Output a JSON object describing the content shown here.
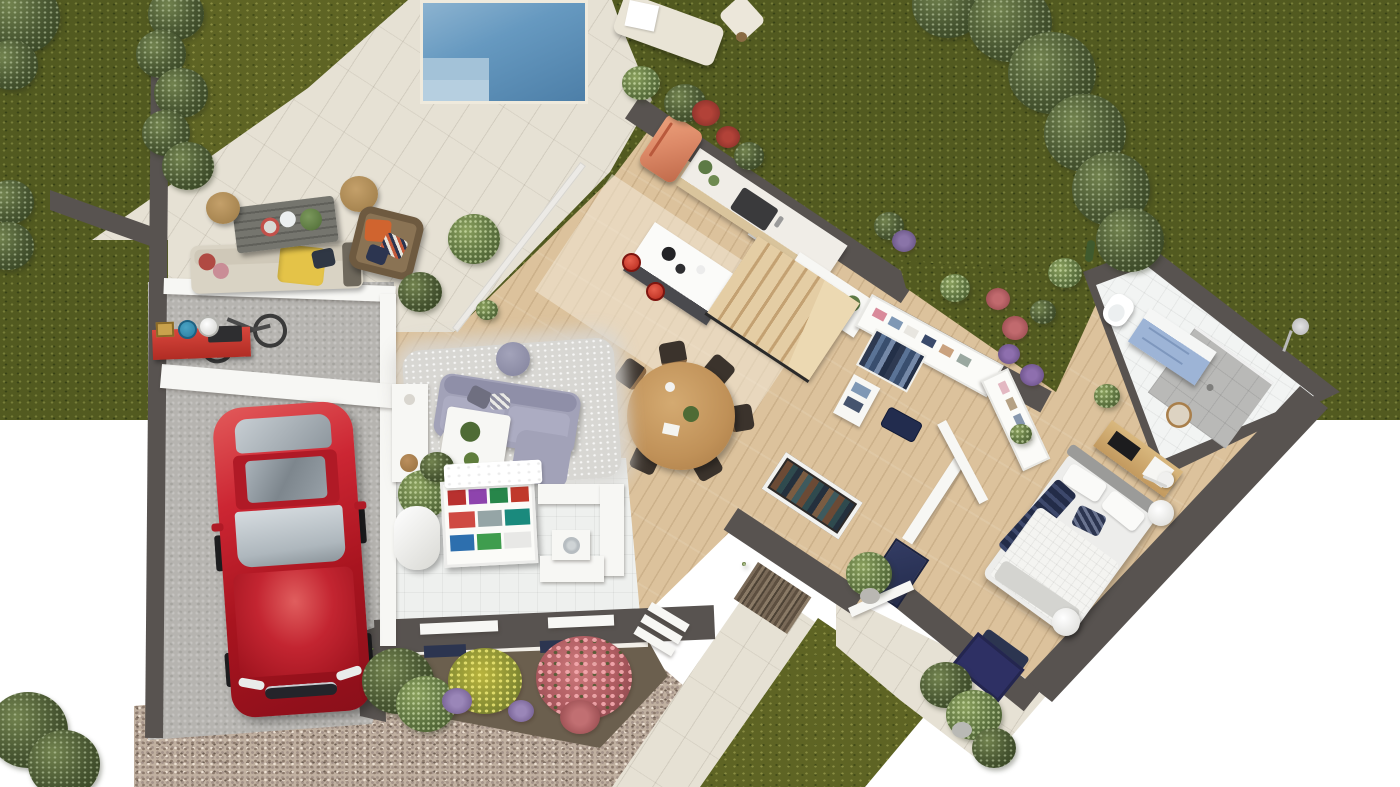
{
  "scene": {
    "type": "3d-floor-plan-render",
    "description": "Top-down 3D architectural rendering of a single-storey house ground floor with garden, swimming pool, terraces, garage with red car, and gravel driveway on a white background",
    "background_color": "#ffffff",
    "visible_text": "none"
  },
  "palette": {
    "exterior_wall": "#585350",
    "interior_wall": "#f7f7f4",
    "wood_floor": "#dcc29c",
    "pavers": "#e6e1d4",
    "concrete": "#b6b4b0",
    "gravel": "#c0b0a0",
    "grass": "#5e6424",
    "pool_water": "#5f93be",
    "car_red": "#c0232c",
    "fridge_coral": "#dd8a68",
    "vanity_blue": "#9db4d6",
    "navy_accent": "#2c3550",
    "sofa_lavender": "#a2a2b8",
    "stool_red": "#d23b2e"
  },
  "rooms": {
    "garden_north": {
      "label": "North garden lawn with trees"
    },
    "lawn_west": {
      "label": "West lawn with hedge"
    },
    "pool": {
      "label": "Swimming pool with steps"
    },
    "pool_deck": {
      "label": "Pool deck and paved terrace"
    },
    "outdoor_lounge": {
      "label": "Outdoor lounge on terrace"
    },
    "garage": {
      "label": "Garage / carport"
    },
    "kitchen": {
      "label": "Open kitchen"
    },
    "dining": {
      "label": "Dining area"
    },
    "living": {
      "label": "Living area"
    },
    "utility": {
      "label": "Utility / storage room"
    },
    "staircase": {
      "label": "Wooden staircase"
    },
    "hallway": {
      "label": "Entry hallway"
    },
    "dressing": {
      "label": "Walk-in closet"
    },
    "bathroom": {
      "label": "Bathroom with shower"
    },
    "bedroom": {
      "label": "Bedroom"
    },
    "terrace_se": {
      "label": "South-east terrace"
    },
    "garden_se": {
      "label": "South-east grass patch"
    },
    "driveway": {
      "label": "Gravel driveway"
    },
    "flower_bed": {
      "label": "Flower bed with roses and lavender"
    },
    "walkway": {
      "label": "Paved entry walkway"
    },
    "garden_pocket": {
      "label": "Planted border above closet"
    }
  },
  "objects": {
    "car": {
      "label": "Red sports car parked nose-first",
      "color": "#c0232c"
    },
    "bicycle": {
      "label": "Bicycle hung on garage wall"
    },
    "workbench": {
      "label": "Red garage workbench with buckets and toolbox"
    },
    "water_heater": {
      "label": "White cylindrical water heater"
    },
    "daybed": {
      "label": "Cream sun lounger with towel"
    },
    "outdoor_sofa": {
      "label": "Outdoor sofa with yellow throw"
    },
    "outdoor_table": {
      "label": "Gray slatted coffee table with plates and plant"
    },
    "poufs": {
      "label": "Rattan poufs",
      "count": 2
    },
    "rattan_armchair": {
      "label": "Rattan armchair with colorful cushions"
    },
    "fridge": {
      "label": "Retro coral refrigerator",
      "color": "#dd8a68"
    },
    "kitchen_counter": {
      "label": "Kitchen counter with dark sink"
    },
    "kitchen_island": {
      "label": "White kitchen island"
    },
    "bar_stools": {
      "label": "Red bar stools",
      "count": 2
    },
    "cooktop": {
      "label": "Black induction cooktop"
    },
    "stairs": {
      "label": "Wood stairs with landing"
    },
    "dining_table": {
      "label": "Round wooden dining table"
    },
    "dining_chairs": {
      "label": "Dark dining chairs",
      "count": 6
    },
    "rug": {
      "label": "Shaggy light-gray rug"
    },
    "sofa": {
      "label": "Lavender-gray chaise sofa"
    },
    "coffee_table": {
      "label": "White coffee table with plants"
    },
    "tv_unit": {
      "label": "White sideboard along garage wall"
    },
    "storage_shelf": {
      "label": "Shelf with colorful storage boxes"
    },
    "desk": {
      "label": "White built-in counter with washing machine"
    },
    "entry_wardrobe": {
      "label": "Open entry wardrobe with coats"
    },
    "stone_wall": {
      "label": "Stone-clad entrance wall"
    },
    "entry_plant": {
      "label": "Potted plant at entry"
    },
    "navy_door": {
      "label": "Navy front door"
    },
    "closet_shelves": {
      "label": "White closet shelving with clothes"
    },
    "hanging_clothes": {
      "label": "Hanging clothes rail"
    },
    "suitcase": {
      "label": "Navy suitcase"
    },
    "toilet": {
      "label": "White toilet"
    },
    "vanity": {
      "label": "Blue bathroom vanity",
      "color": "#9db4d6"
    },
    "shower": {
      "label": "Walk-in shower with gray tiles"
    },
    "shower_head": {
      "label": "Exterior shower fixture"
    },
    "mirror": {
      "label": "Round mirror"
    },
    "bed": {
      "label": "Double bed with navy throw"
    },
    "side_table": {
      "label": "Round white side table"
    },
    "floor_lamp": {
      "label": "White arc floor lamp"
    },
    "media_bench": {
      "label": "Wooden media bench with TV"
    },
    "foot_bench": {
      "label": "Navy bench at bed foot",
      "color": "#2c3550"
    },
    "navy_rug": {
      "label": "Navy outdoor rug"
    },
    "monstera": {
      "label": "Monstera plant in pot"
    },
    "pool_steps": {
      "label": "Pool entry steps"
    }
  }
}
